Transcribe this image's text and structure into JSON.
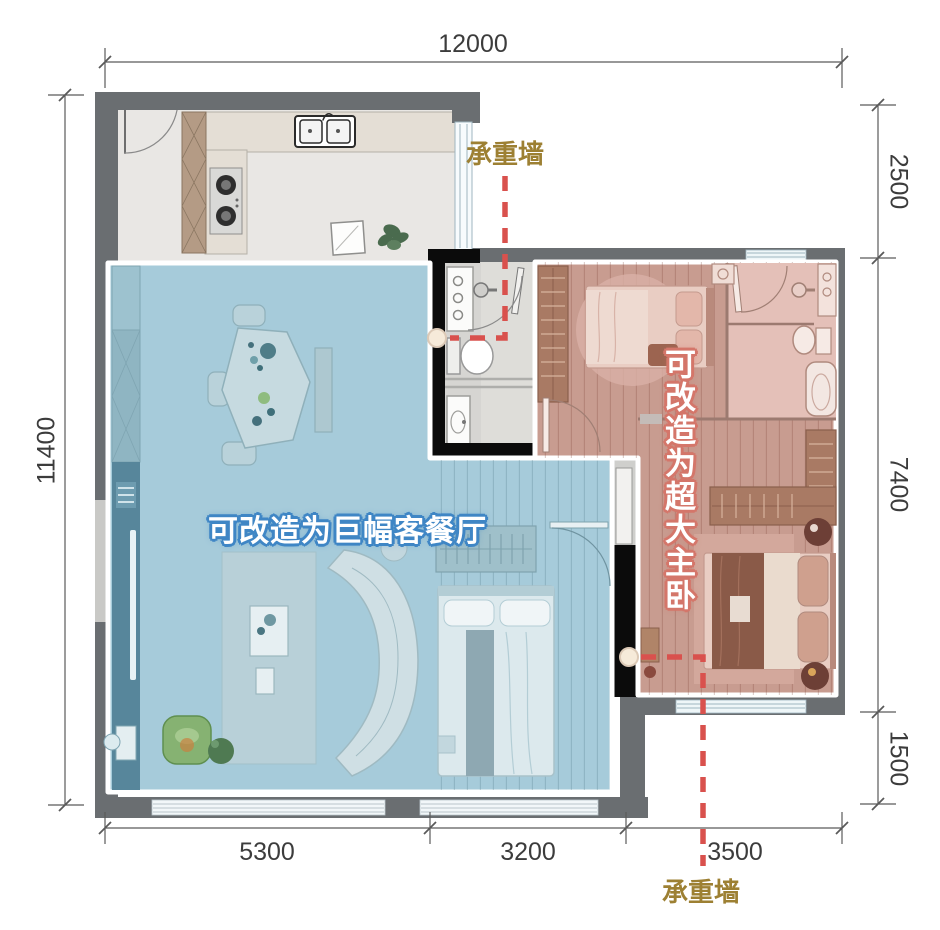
{
  "plan": {
    "type": "apartment-floor-plan",
    "colors": {
      "wall_grey": "#6a6e71",
      "wall_black": "#0b0b0b",
      "blue_overlay": "#a6cbda",
      "blue_note_outline": "#3f86c5",
      "pink_overlay": "#c89c90",
      "pink_tile": "#e4c0b8",
      "red_dashed": "#d9514d",
      "gold_annotation": "#9d8033",
      "dimension_text": "#3c3c3c"
    }
  },
  "dimensions": {
    "top": {
      "total": "12000"
    },
    "bottom": {
      "segments": [
        "5300",
        "3200",
        "3500"
      ]
    },
    "left": {
      "total": "11400"
    },
    "right": {
      "segments": [
        "2500",
        "7400",
        "1500"
      ]
    }
  },
  "annotations": {
    "load_bearing_top": "承重墙",
    "load_bearing_bottom": "承重墙",
    "living_area_note": "可改造为巨幅客餐厅",
    "master_bedroom_note": "可改造为超大主卧"
  }
}
